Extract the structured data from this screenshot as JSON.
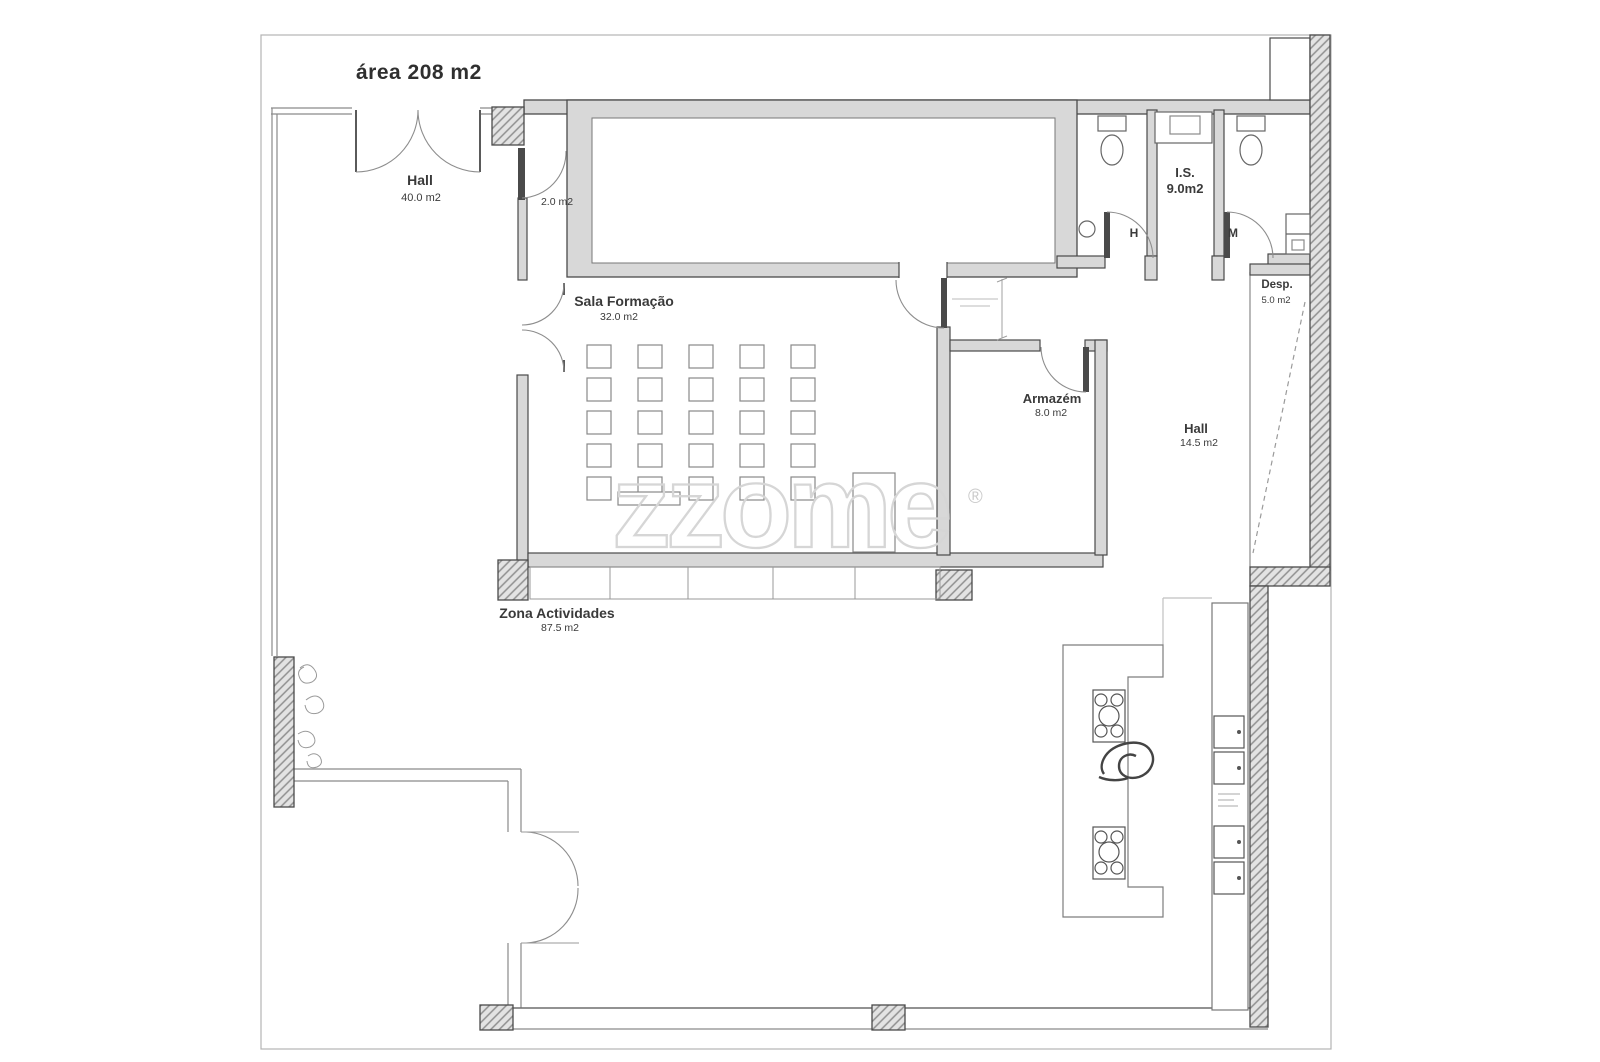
{
  "document": {
    "title": "área 208 m2"
  },
  "watermark": {
    "brand": "zzome",
    "registered": "®"
  },
  "rooms": {
    "hall_entrance": {
      "name": "Hall",
      "area": "40.0 m2"
    },
    "vestibule": {
      "area": "2.0 m2"
    },
    "sala_formacao": {
      "name": "Sala Formação",
      "area": "32.0 m2"
    },
    "sanitary": {
      "name": "I.S.",
      "area": "9.0m2",
      "men": "H",
      "women": "M"
    },
    "despensa": {
      "name": "Desp.",
      "area": "5.0 m2"
    },
    "armazem": {
      "name": "Armazém",
      "area": "8.0 m2"
    },
    "hall_back": {
      "name": "Hall",
      "area": "14.5 m2"
    },
    "zona_actividades": {
      "name": "Zona Actividades",
      "area": "87.5 m2"
    }
  },
  "colors": {
    "wall_dark": "#4a4a4a",
    "wall_fill": "#d8d8d8",
    "hatch_line": "#8f8f8f",
    "thin_line": "#8a8a8a",
    "text": "#3a3a3a",
    "watermark": "#d6d6d6",
    "border": "#b3b3b3"
  }
}
